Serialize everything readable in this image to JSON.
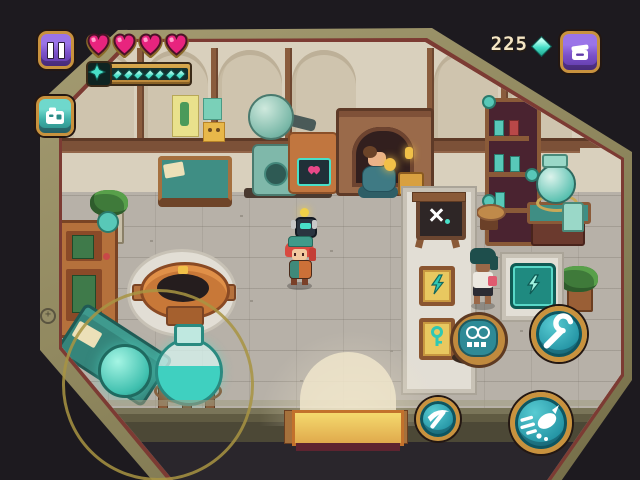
{
  "hud": {
    "currency": {
      "value": "225",
      "gem_icon": "gem-icon",
      "gem_color": "#48e0c8"
    },
    "hearts": {
      "count": 4,
      "fill_color": "#e8247e"
    },
    "energy_bar": {
      "pip_count": 7,
      "pip_color": "#48e0c8",
      "cap_icon": "spark-star-icon"
    },
    "buttons": {
      "pause": {
        "icon": "pause-icon"
      },
      "camera": {
        "icon": "camera-icon"
      },
      "bag": {
        "icon": "bag-icon"
      },
      "wrench": {
        "icon": "wrench-icon"
      },
      "dash": {
        "icon": "dash-icon"
      },
      "gadget": {
        "icon": "pickaxe-icon"
      }
    },
    "joystick_visible": true
  },
  "scene": {
    "location": "workshop-interior",
    "objects": [
      "alchemy-machine",
      "heart-screen",
      "fireplace",
      "seated-npc",
      "gold-chest",
      "wall-posters",
      "desk",
      "bookshelf",
      "potion-table",
      "glass-orb",
      "stool",
      "plant-right",
      "plant-left",
      "cabinet",
      "basin",
      "workbench",
      "glow-dome",
      "glass-flask",
      "display-mat",
      "crafting-sign",
      "lightning-tile",
      "key-tile",
      "teal-pad",
      "round-machine",
      "shopkeeper-npc",
      "player-character",
      "companion-drone",
      "door-light"
    ],
    "accent_teal": "#3fbfae",
    "wood_brown": "#8a5a38",
    "wall_cream": "#d9d0bd"
  }
}
